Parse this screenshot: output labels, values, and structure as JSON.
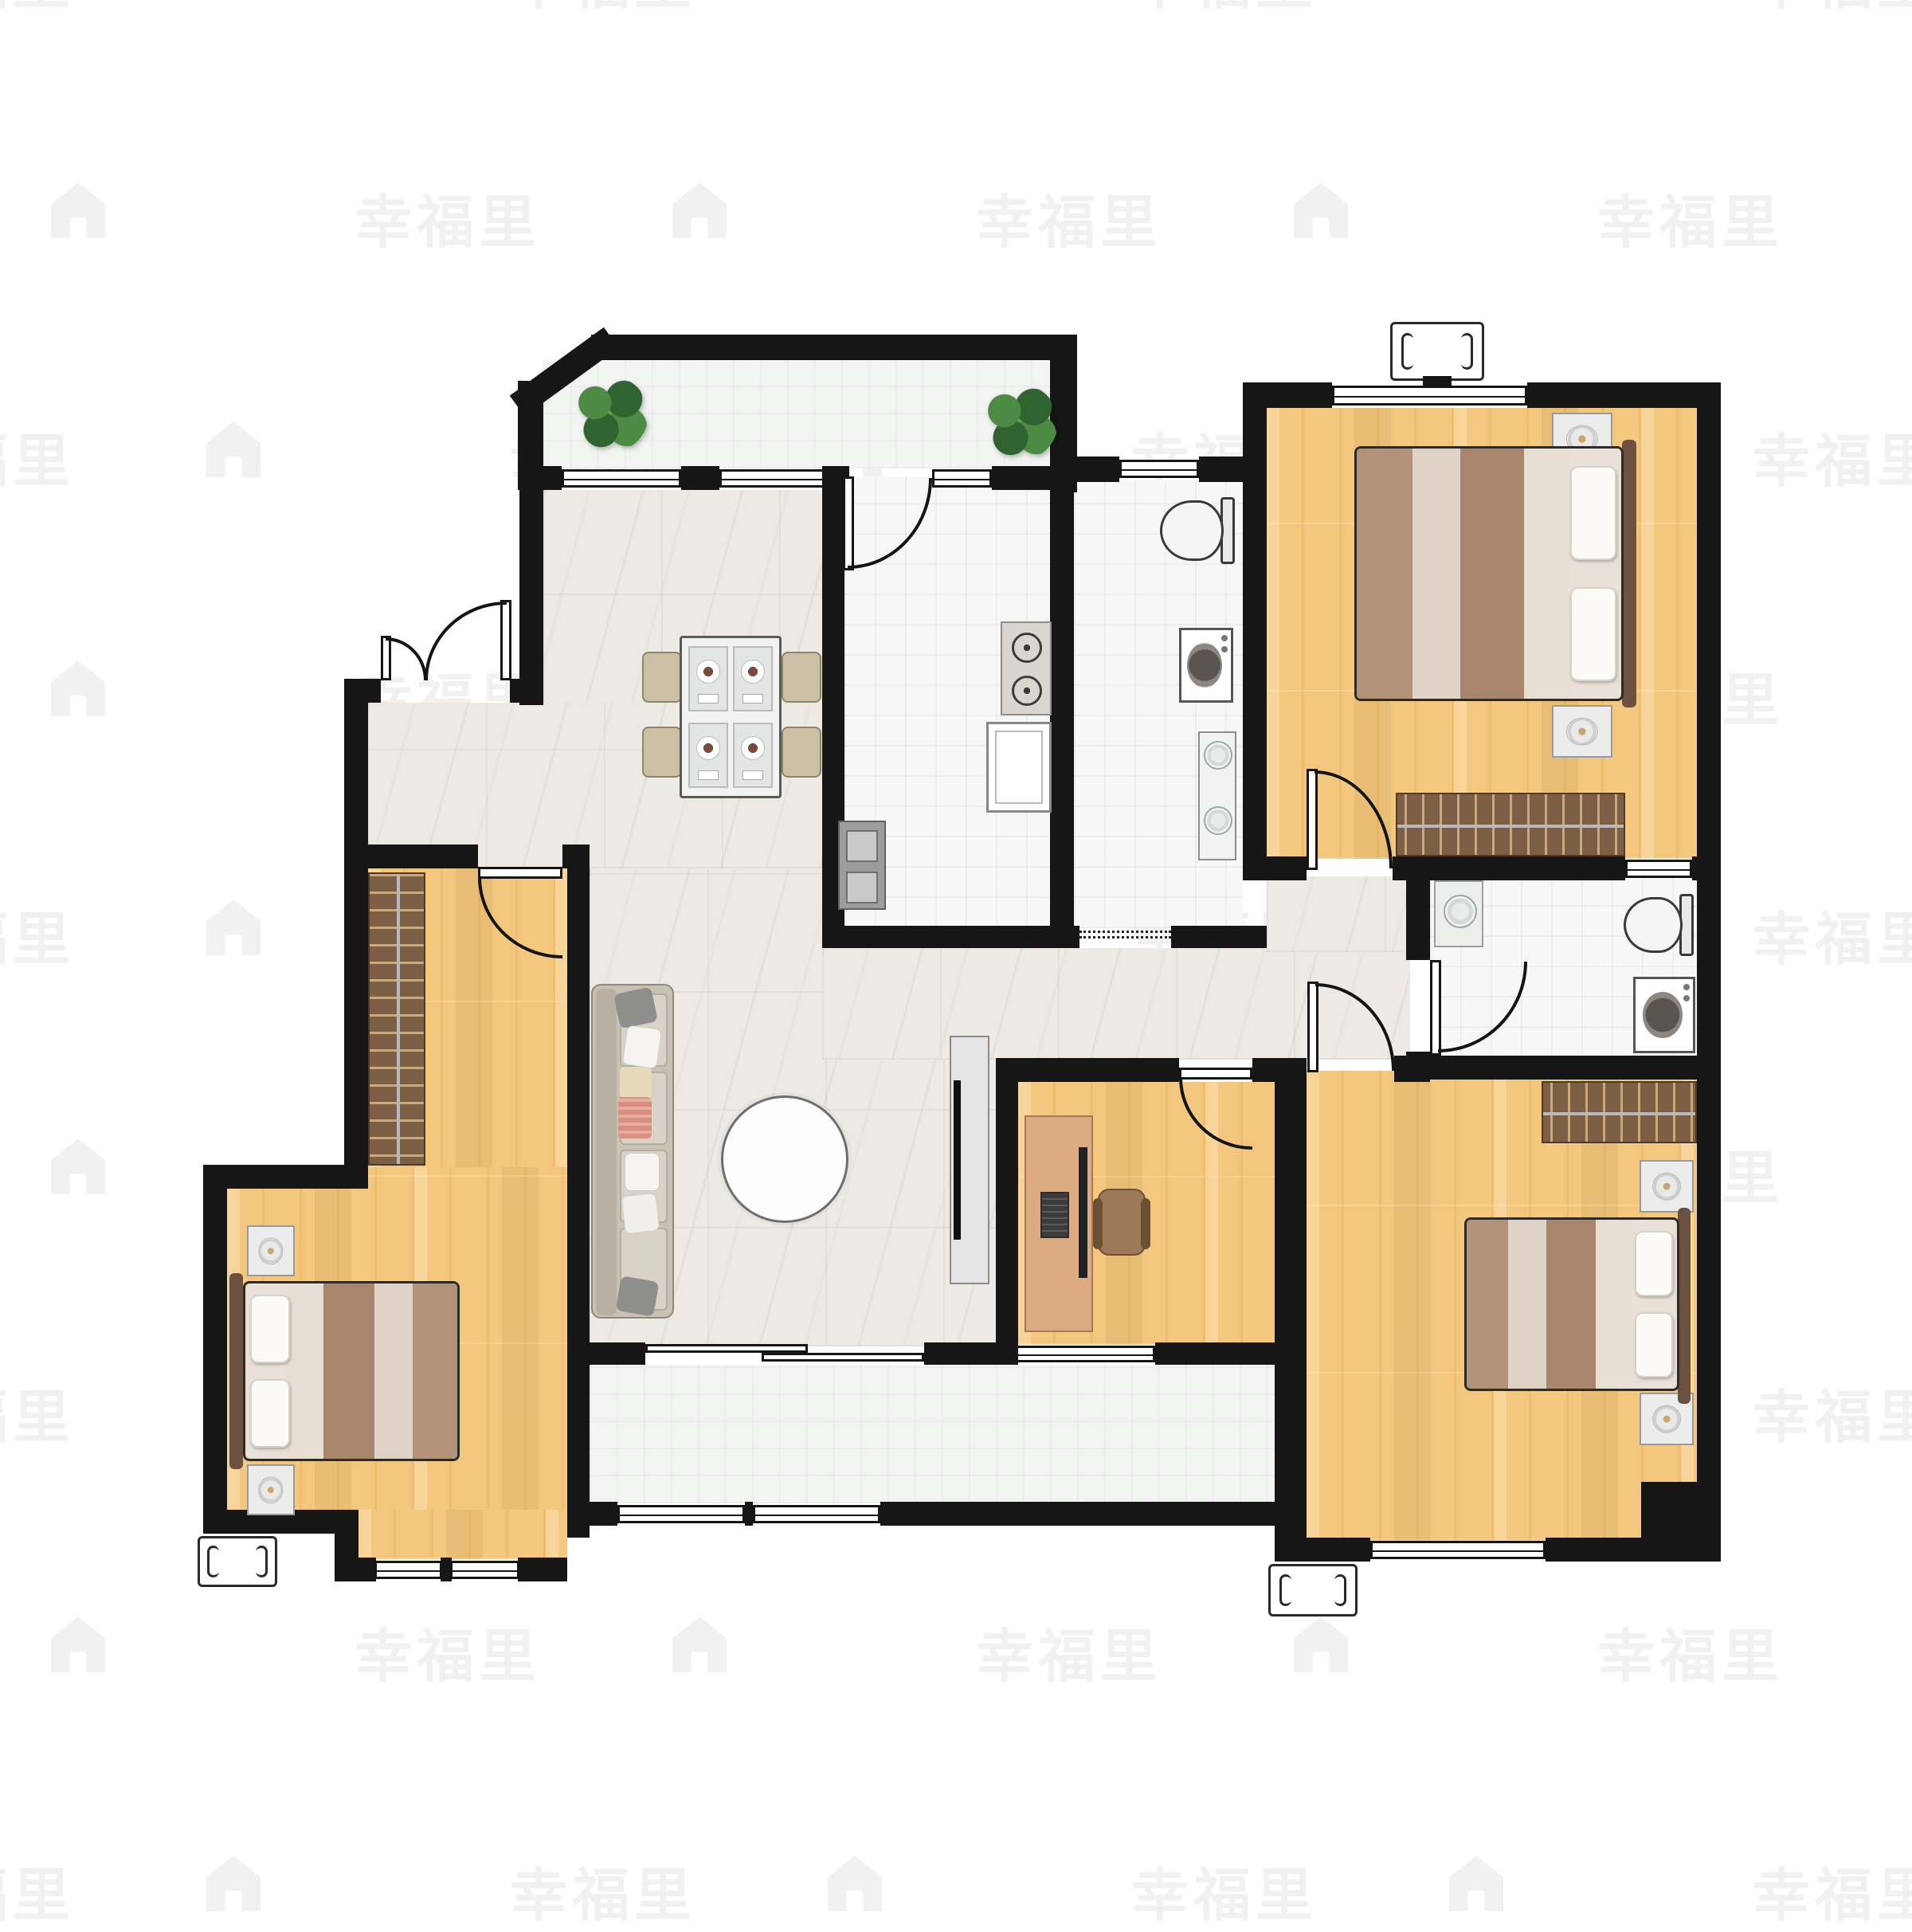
{
  "meta": {
    "kind": "real-estate floor plan image",
    "visible_text_only": true
  },
  "watermark": {
    "text": "幸福里",
    "icon": "house-icon",
    "color": "#f1f1f1"
  },
  "palette": {
    "wall": "#161616",
    "background": "#ffffff",
    "marble_floor": "#edeae6",
    "wood_floor": "#f3c87e",
    "bath_tile": "#f6f7f6",
    "balcony_tile": "#f2f4f2",
    "wardrobe_brown": "#7d5f45",
    "plant_green": "#2f6330",
    "bed_blanket_brown": "#b3927a",
    "sofa_beige": "#c9c2b4",
    "accent_pillow_red": "#d98f82"
  },
  "rooms": [
    {
      "id": "balcony-top",
      "floor": "balcony_tile",
      "features": [
        "plant",
        "plant",
        "windows"
      ]
    },
    {
      "id": "dining-hall",
      "floor": "marble_floor",
      "features": [
        "dining-table",
        "four-chairs",
        "entry-double-door"
      ]
    },
    {
      "id": "kitchen",
      "floor": "bath_tile",
      "features": [
        "gas-stove",
        "counter",
        "sink",
        "door-arc"
      ]
    },
    {
      "id": "bathroom-main",
      "floor": "bath_tile",
      "features": [
        "toilet",
        "washing-machine",
        "double-sink-vanity",
        "window",
        "dashed-opening"
      ]
    },
    {
      "id": "bedroom-top-right",
      "floor": "wood_floor",
      "features": [
        "double-bed",
        "two-nightstands",
        "wardrobe",
        "window",
        "ac-unit",
        "door"
      ]
    },
    {
      "id": "living-room",
      "floor": "marble_floor",
      "features": [
        "sofa",
        "round-rug",
        "tv-stand"
      ]
    },
    {
      "id": "study",
      "floor": "wood_floor",
      "features": [
        "desk",
        "monitor",
        "keyboard",
        "office-chair",
        "door",
        "window"
      ]
    },
    {
      "id": "bathroom-second",
      "floor": "bath_tile",
      "features": [
        "sink",
        "toilet",
        "washing-machine",
        "door",
        "window"
      ]
    },
    {
      "id": "bedroom-bottom-right",
      "floor": "wood_floor",
      "features": [
        "double-bed",
        "two-nightstands",
        "wardrobe",
        "window",
        "ac-unit",
        "door"
      ]
    },
    {
      "id": "master-bedroom",
      "floor": "wood_floor",
      "features": [
        "double-bed",
        "two-nightstands",
        "wardrobe",
        "window",
        "ac-unit",
        "door"
      ]
    },
    {
      "id": "balcony-bottom",
      "floor": "balcony_tile",
      "features": [
        "sliding-door",
        "windows"
      ]
    }
  ]
}
